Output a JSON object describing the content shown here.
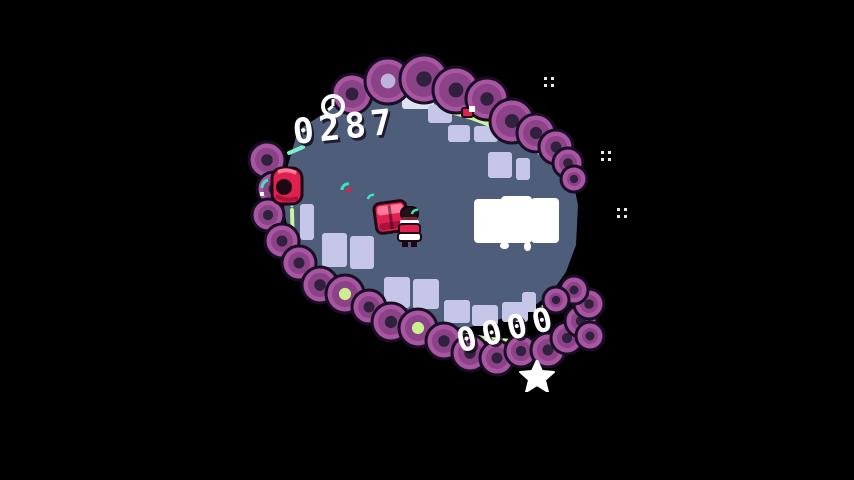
{
  "screen": {
    "name": "gameplay",
    "app": "pixel-arena-game"
  },
  "hud": {
    "timer_icon": "clock-icon",
    "timer_value": "0287",
    "score_icon": "star-icon",
    "score_value": "0000"
  },
  "entities": {
    "player": "player-character",
    "crate": "red-crate",
    "enemy": "red-enemy",
    "distant_enemy": "distant-red-enemy"
  },
  "decorations": {
    "sparkle_icon": "sparkle-icon",
    "sparkle_count": 3
  },
  "sign": {
    "label": ""
  },
  "colors": {
    "background": "#000000",
    "floor": "#4e5e7a",
    "tile": "#c6c7e8",
    "tile_bright": "#dfe2f1",
    "blob_outer": "#a855a2",
    "blob_mid": "#8b4287",
    "blob_hole": "#31203e",
    "blob_hole_green": "#cdee8e",
    "blob_hole_lavender": "#beb3e0",
    "blob_outline": "#190f24",
    "rim_green": "#cdf59b",
    "rim_teal": "#7bf0cb",
    "accent_red": "#e02050",
    "accent_red_light": "#ff7a9a",
    "accent_red_dark": "#a8123c",
    "outline_dark": "#1c0713",
    "white": "#ffffff",
    "particle_teal": "#3fe2b8",
    "sparkle": "#e3ecdf"
  }
}
